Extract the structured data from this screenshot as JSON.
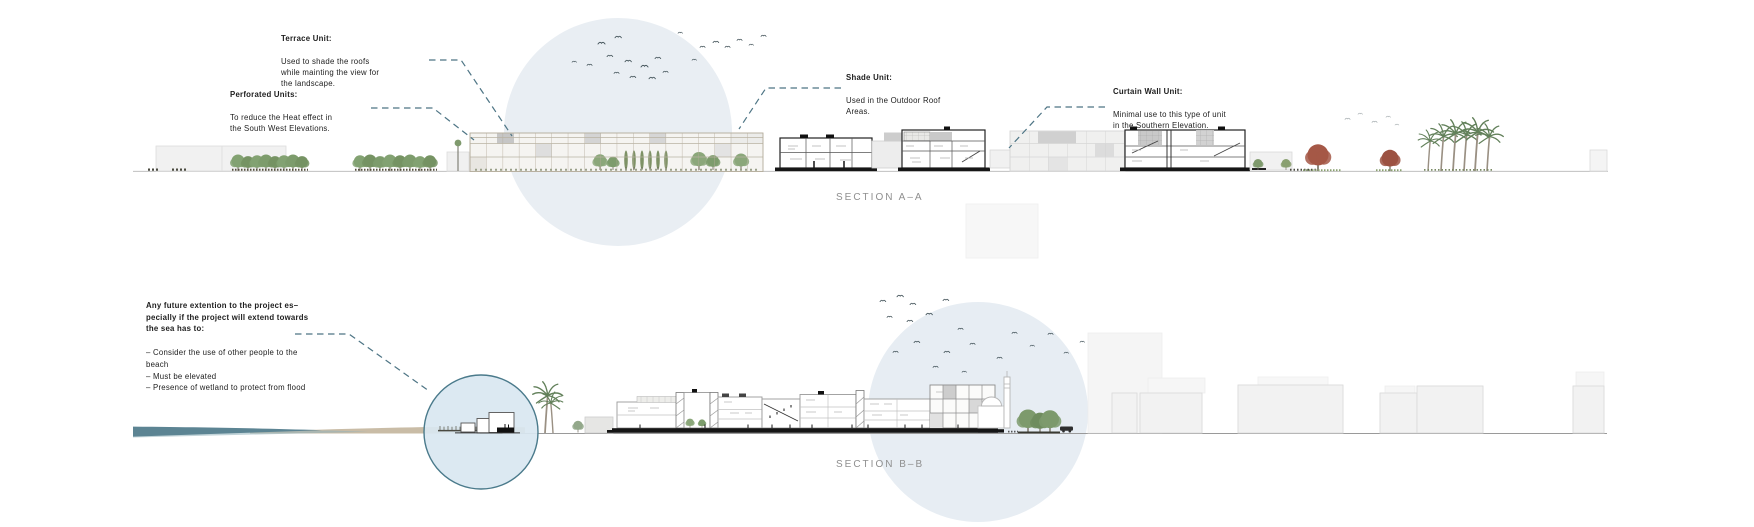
{
  "annotations": {
    "terrace_unit": {
      "title": "Terrace Unit:",
      "body": "Used to shade the roofs\nwhile mainting the view for\nthe landscape."
    },
    "perforated_units": {
      "title": "Perforated Units:",
      "body": "To reduce the Heat effect in\nthe South West Elevations."
    },
    "shade_unit": {
      "title": "Shade Unit:",
      "body": "Used in the Outdoor Roof\nAreas."
    },
    "curtain_wall_unit": {
      "title": "Curtain Wall Unit:",
      "body": "Minimal use to this type of unit\nin the Southern Elevation."
    },
    "future_extension": {
      "title": "Any future extention to the project es–\npecially if the project will extend towards\nthe sea has to:",
      "body": "– Consider the use of other people to the\nbeach\n– Must be elevated\n– Presence of wetland to protect from flood"
    }
  },
  "sections": {
    "a": {
      "label": "SECTION A–A"
    },
    "b": {
      "label": "SECTION B–B"
    }
  },
  "colors": {
    "leader_line": "#4E7585",
    "highlight_circle_fill": "#E9EEF3",
    "focus_circle_stroke": "#4A7A8B",
    "focus_circle_fill": "#D9E7F1",
    "water": "#5C8493",
    "sand": "#C9BCA6",
    "section_label_text": "#8F8F8F",
    "annotation_text": "#1D1D1D",
    "tree_green": "#83A272",
    "tree_red": "#A55847"
  }
}
